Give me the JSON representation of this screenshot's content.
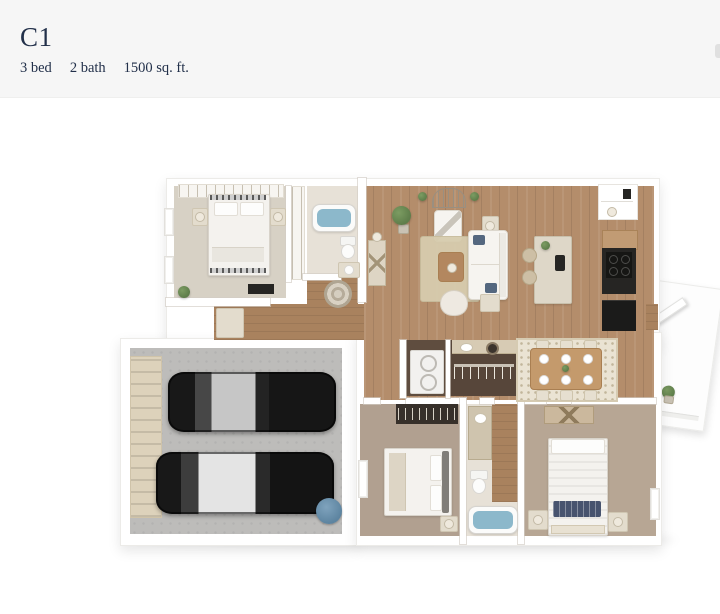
{
  "header": {
    "title": "C1",
    "specs": [
      "3 bed",
      "2 bath",
      "1500 sq. ft."
    ]
  },
  "colors": {
    "page_bg": "#ffffff",
    "header_bg": "#f6f6f6",
    "title_text": "#22304a",
    "wall": "#ffffff",
    "wall_edge": "#ecebe8",
    "wood": "#b48d6b",
    "wood_hall": "#a9825e",
    "carpet_light": "#d7d1c5",
    "carpet_taupe": "#b1a090",
    "carpet_tan": "#b7a694",
    "garage_floor": "#bdbcba",
    "garage_door": "#ddd2bb",
    "jute_rug": "#d7ccae",
    "dining_rug": "#eae3d3",
    "water": "#8cb8cb",
    "appliance_dark": "#262523",
    "car_glass": "#c6c6c6",
    "heater": "#5d84a0",
    "plant": "#5e7d4a"
  },
  "floorplan": {
    "type": "3d-top-down-floorplan",
    "rooms": [
      "bedroom-1",
      "bathroom-1",
      "hallway",
      "living-room",
      "kitchen",
      "dining-area",
      "laundry",
      "walk-in-closet",
      "two-car-garage",
      "bedroom-2",
      "bathroom-2",
      "bedroom-3",
      "entry-porch"
    ],
    "cars_in_garage": 2
  }
}
